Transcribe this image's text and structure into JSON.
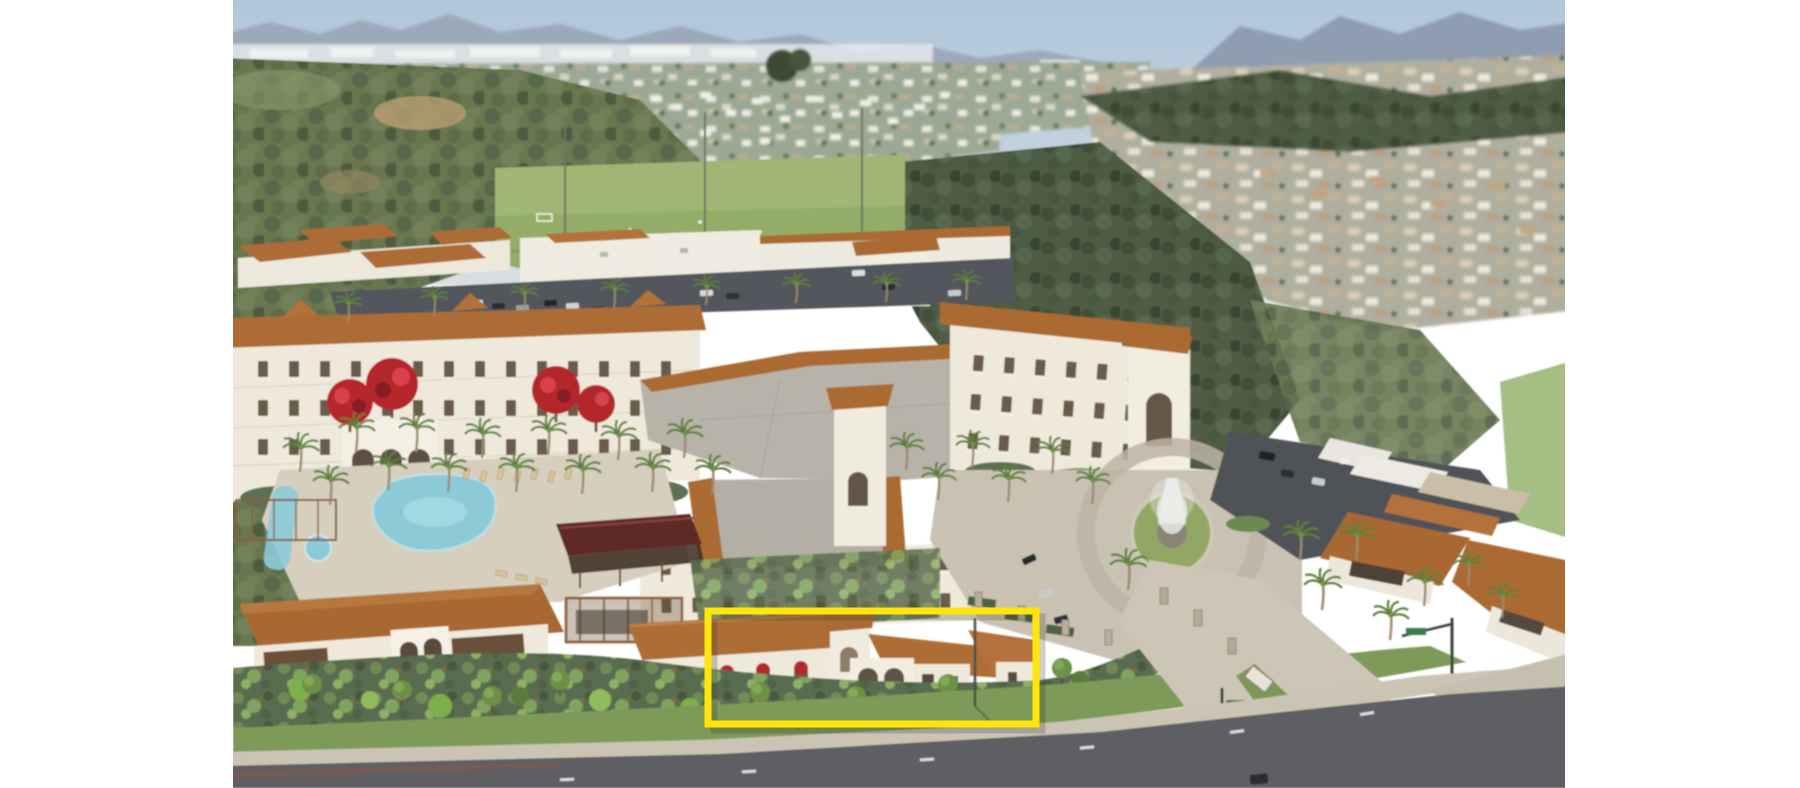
{
  "page": {
    "background_color": "#ffffff",
    "kind": "document page containing one annotated image, no visible text"
  },
  "figure": {
    "kind": "aerial architectural rendering",
    "subject": "Mediterranean-style multi-story residential community with red tile roofs, courtyard swimming pool, entry fountain court, palm-lined drives and parking; sports fields, canyon brush and hillside housing tracts beyond; arterial road in the foreground",
    "x": 233,
    "y": 0,
    "width": 1332,
    "height": 788
  },
  "annotation": {
    "shape": "rectangle",
    "x": 708,
    "y": 611,
    "width": 328,
    "height": 113,
    "stroke_color": "#FFE608",
    "stroke_width": 7,
    "fill": "none",
    "highlights": "single-story wing with tower and arched colonnade at the street frontage"
  },
  "palette": {
    "sky_top": "#afc6da",
    "sky_horizon": "#d4dce1",
    "mountains": "#93a0b4",
    "haze": "#e9ecec",
    "hill_trees": "#67774f",
    "dark_brush": "#49583e",
    "field_green": "#93ad68",
    "infield_dirt": "#c7a876",
    "roof_terracotta": "#ab6a33",
    "wall_cream": "#efe9dc",
    "flat_roof_gray": "#b8b3a8",
    "parking_asphalt": "#53575c",
    "plaza_concrete": "#c9c2b3",
    "road_asphalt": "#5e5f63",
    "sidewalk": "#cbc4b5",
    "lawn": "#7e9a59",
    "shrub_bed": "#5a6c4f",
    "pool_water": "#8ccad8",
    "pavilion_roof": "#5f2b25",
    "flower_red": "#b5262c",
    "palm_frond": "#5d7f3b",
    "annotation_yellow": "#FFE608"
  }
}
